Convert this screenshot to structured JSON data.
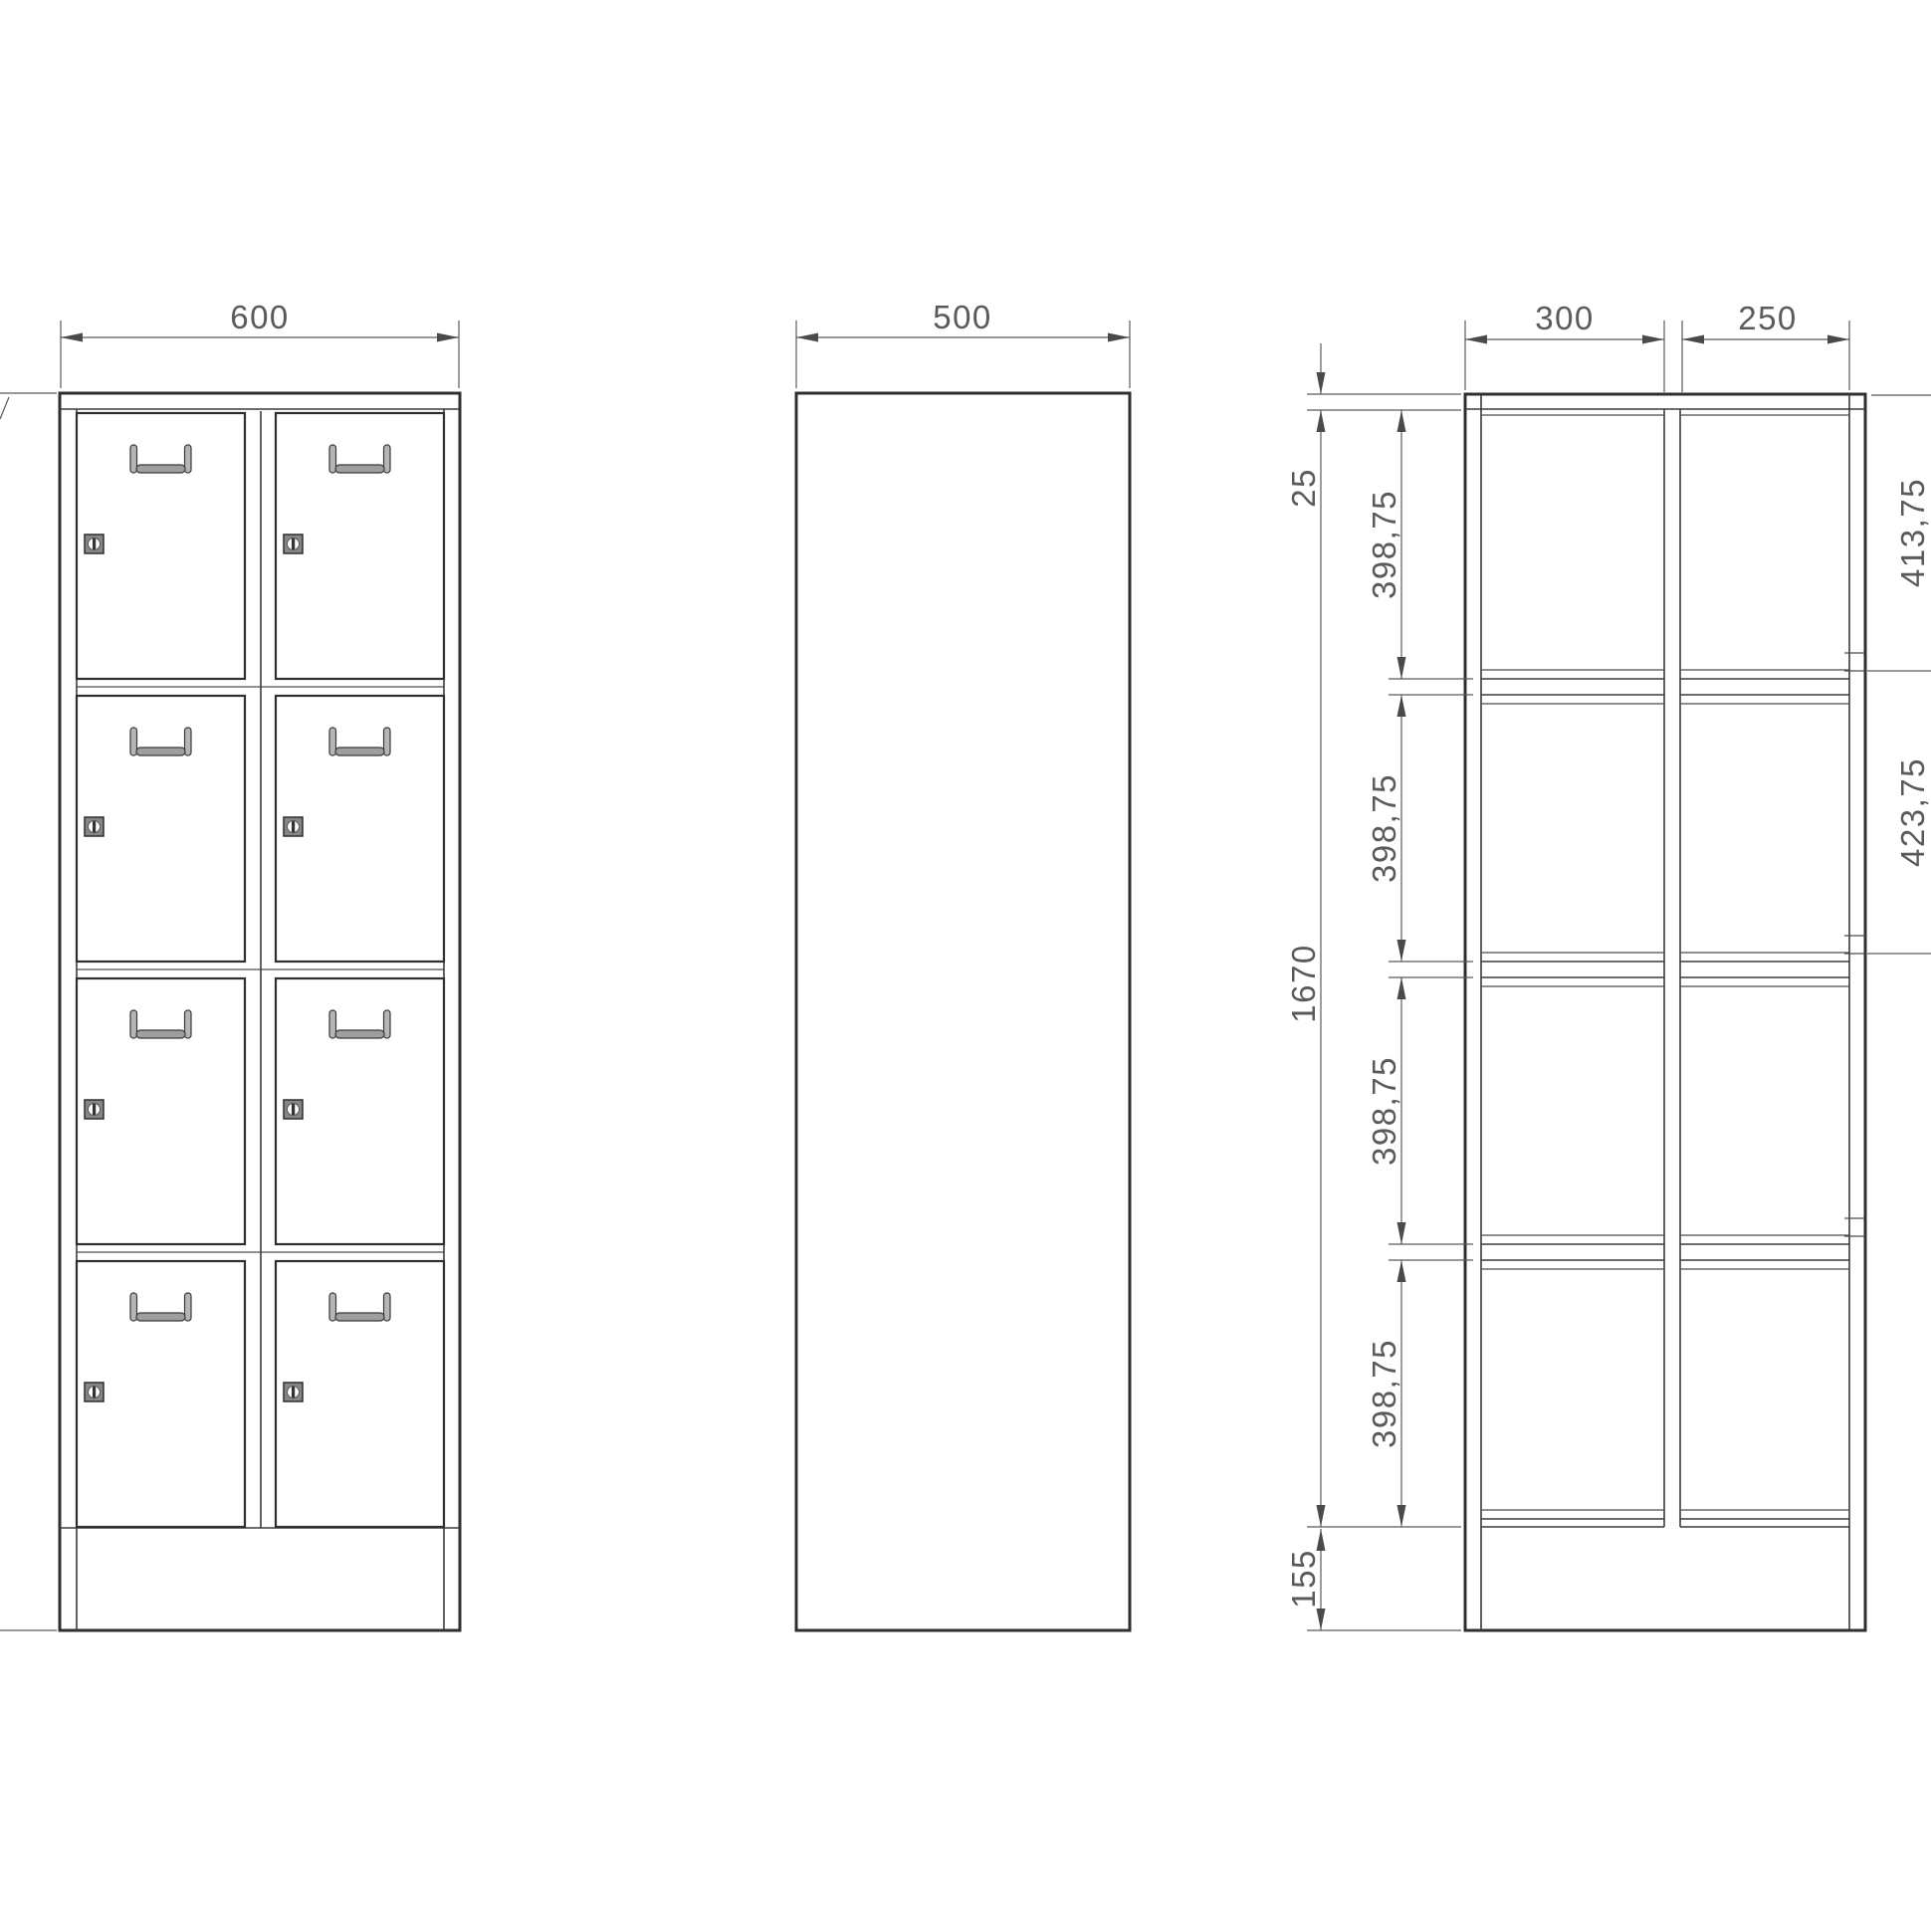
{
  "drawing": {
    "type": "technical-drawing",
    "subject": "locker-cabinet-three-views",
    "front_view": {
      "width_dim": "600"
    },
    "side_view": {
      "depth_dim": "500"
    },
    "section_view": {
      "left_column_dim": "300",
      "right_column_dim": "250",
      "top_panel_dim": "25",
      "inner_height_dim": "1670",
      "opening_dims": [
        "398,75",
        "398,75",
        "398,75",
        "398,75"
      ],
      "plinth_dim": "155",
      "top_door_dim": "413,75",
      "door_pitch_dim": "423,75"
    },
    "colors": {
      "background": "#ffffff",
      "outline": "#2f2f2f",
      "dimension": "#5a5a5a",
      "text": "#5a5a5a",
      "handle_fill": "#b5b5b5",
      "lock_fill": "#868686"
    }
  }
}
